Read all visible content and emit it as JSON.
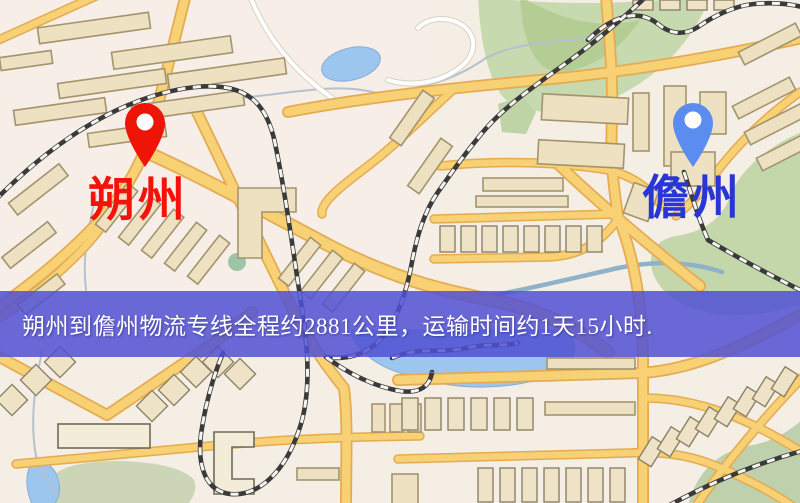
{
  "map": {
    "origin": {
      "name": "朔州",
      "pin_icon": "red-map-pin",
      "pin_color": "#ee1506",
      "label_color": "#f4120a"
    },
    "destination": {
      "name": "儋州",
      "pin_icon": "blue-map-pin",
      "pin_color": "#5b8cf0",
      "label_color": "#2836d6"
    },
    "banner": {
      "text": "朔州到儋州物流专线全程约2881公里，运输时间约1天15小时.",
      "distance_km": "2881",
      "duration": "1天15小时",
      "background_color": "#5050d4",
      "text_color": "#ffffff"
    },
    "colors": {
      "land": "#f4eee5",
      "road": "#f7d173",
      "road_border": "#e4ab52",
      "white_road": "#ffffff",
      "building": "#ede1c1",
      "building_border": "#a3946e",
      "park": "#c7d9ae",
      "water": "#9dc6ee",
      "railway": "#3a3a3a"
    }
  }
}
